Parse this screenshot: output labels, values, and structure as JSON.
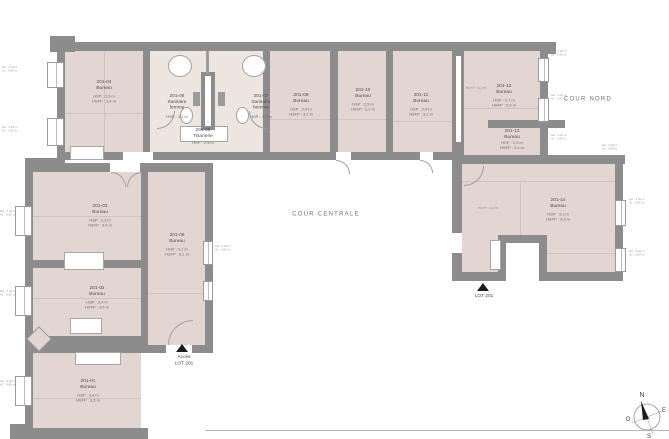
{
  "plan": {
    "labels": {
      "cour_centrale": "COUR CENTRALE",
      "cour_nord": "COUR NORD",
      "acces_line1": "Accès",
      "acces_line2": "LOT 201",
      "lot_201": "LOT 201"
    },
    "compass": {
      "n": "N",
      "e": "E",
      "s": "S",
      "o": "O"
    },
    "window_tag": {
      "line1": "HA : 2,20 m",
      "line2": "AL : 0,95 m"
    },
    "side_notes": [
      "HSFP : 3,1 m",
      "HSFP : 3,1 m"
    ],
    "rooms": [
      {
        "id": "201-04",
        "n1": "Bureau",
        "n2": "",
        "h1": "HSP : 3,3 m",
        "h2": "HSFP : 3,4 m"
      },
      {
        "id": "201-06",
        "n1": "Sanitaire",
        "n2": "femme",
        "h1": "HSP : 3,3 m",
        "h2": ""
      },
      {
        "id": "201-07",
        "n1": "Sanitaire",
        "n2": "homme",
        "h1": "HSP : 3,3 m",
        "h2": ""
      },
      {
        "id": "201-08",
        "n1": "Tisanerie",
        "n2": "",
        "h1": "HSP : 2,5 m",
        "h2": ""
      },
      {
        "id": "201-09",
        "n1": "Bureau",
        "n2": "",
        "h1": "HSP : 2,9 m",
        "h2": "HSFP : 3,1 m"
      },
      {
        "id": "201-10",
        "n1": "Bureau",
        "n2": "",
        "h1": "HSP : 2,9 m",
        "h2": "HSFP : 3,1 m"
      },
      {
        "id": "201-11",
        "n1": "Bureau",
        "n2": "",
        "h1": "HSP : 2,9 m",
        "h2": "HSFP : 3,1 m"
      },
      {
        "id": "201-12",
        "n1": "Bureau",
        "n2": "",
        "h1": "HSP : 2,7 m",
        "h2": "HSFP : 2,9 m"
      },
      {
        "id": "201-13",
        "n1": "Bureau",
        "n2": "",
        "h1": "HSP : 2,2 m",
        "h2": "HSFP : 2,4 m"
      },
      {
        "id": "201-14",
        "n1": "Bureau",
        "n2": "",
        "h1": "HSP : 3,1 m",
        "h2": "HSFP : 3,3 m"
      },
      {
        "id": "201-05",
        "n1": "Bureau",
        "n2": "",
        "h1": "HSP : 3,1 m",
        "h2": "HSFP : 3,1 m"
      },
      {
        "id": "201-03",
        "n1": "Bureau",
        "n2": "",
        "h1": "HSP : 3,3 m",
        "h2": "HSFP : 3,4 m"
      },
      {
        "id": "201-02",
        "n1": "Bureau",
        "n2": "",
        "h1": "HSP : 3,4 m",
        "h2": "HSFP : 3,5 m"
      },
      {
        "id": "201-01",
        "n1": "Bureau",
        "n2": "",
        "h1": "HSP : 3,4 m",
        "h2": "HSFP : 3,5 m"
      }
    ],
    "colors": {
      "wall": "#8c8c8c",
      "room_fill": "#e3d5d1",
      "sanitaire_fill": "#ede5df",
      "faint_line": "#d1c3be",
      "needle": "#1c1c1c"
    }
  }
}
